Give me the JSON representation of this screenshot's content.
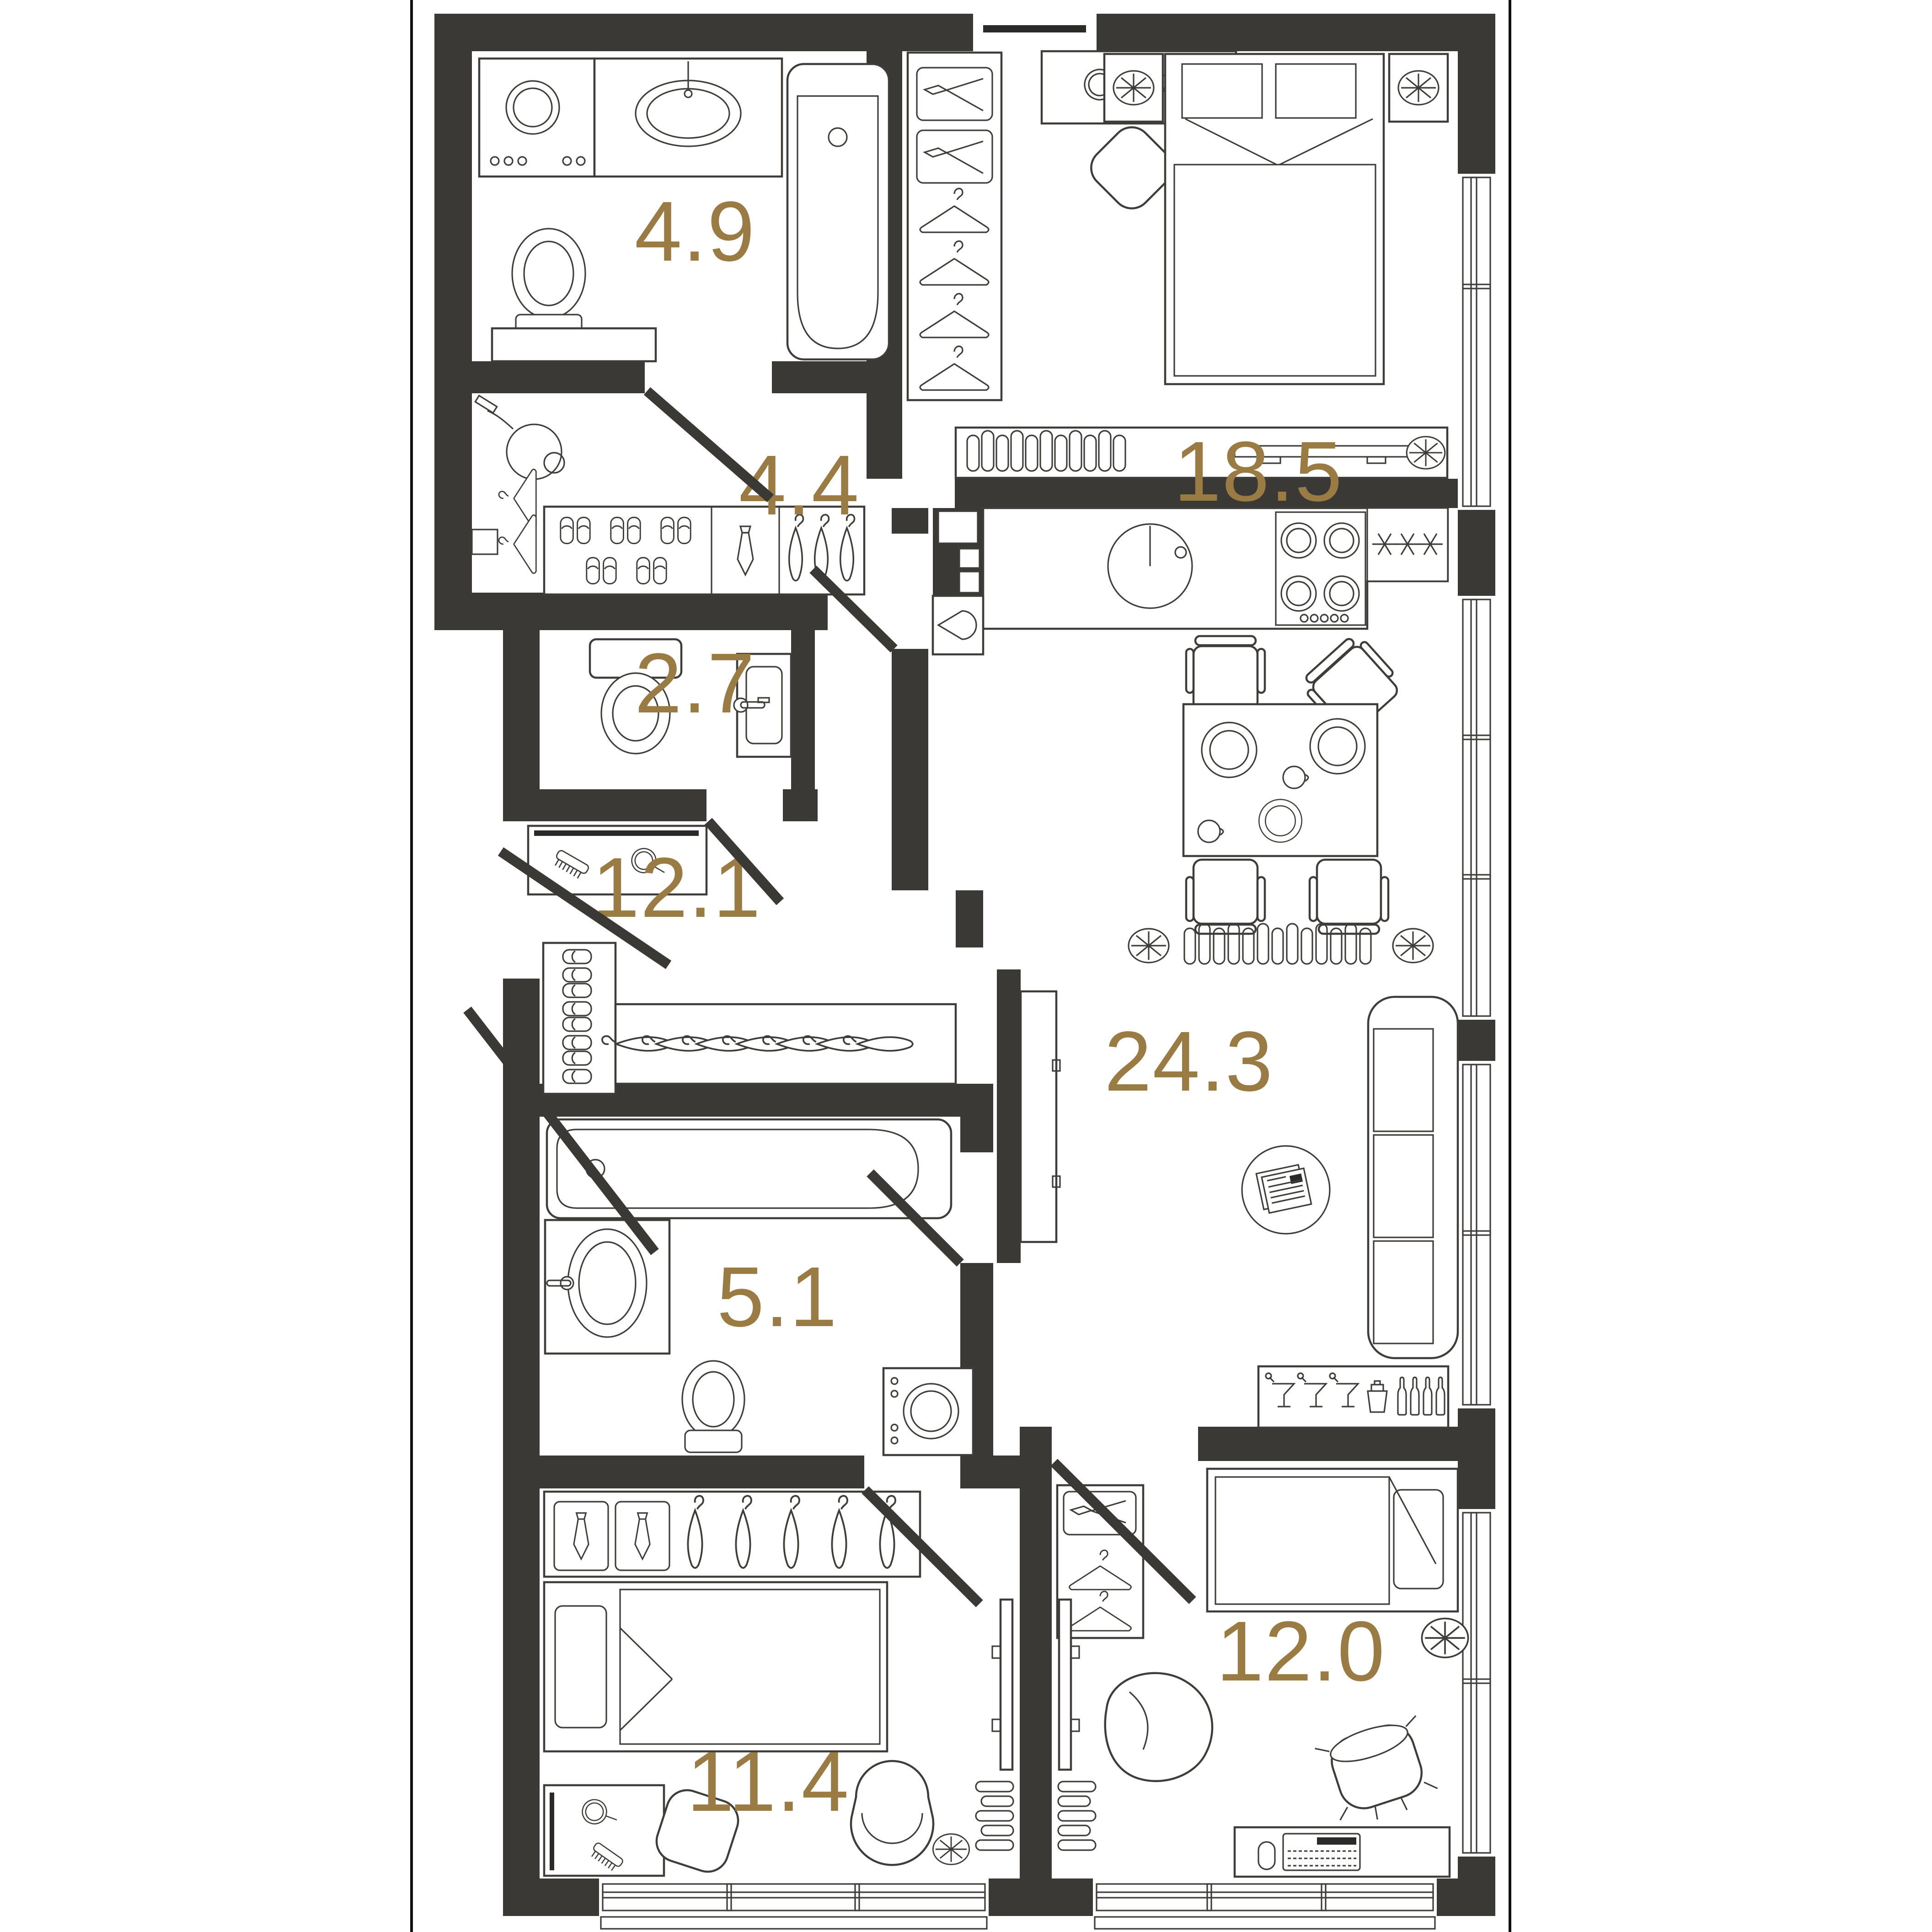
{
  "plan": {
    "type": "apartment-floor-plan",
    "area_unit": "m2",
    "colors": {
      "background": "#ffffff",
      "walls": "#3b3936",
      "furniture_lines": "#3f3d3a",
      "room_labels": "#9a7b44",
      "frame": "#111111"
    },
    "rooms": {
      "bathroom_top": {
        "label": "4.9"
      },
      "hallway": {
        "label": "4.4"
      },
      "bedroom_main": {
        "label": "18.5"
      },
      "wc": {
        "label": "2.7"
      },
      "corridor": {
        "label": "12.1"
      },
      "living_kitchen": {
        "label": "24.3"
      },
      "bathroom_lower": {
        "label": "5.1"
      },
      "bedroom_left": {
        "label": "11.4"
      },
      "bedroom_right": {
        "label": "12.0"
      }
    },
    "furniture_icons": [
      "washing-machine-icon",
      "sink-icon",
      "bathtub-icon",
      "toilet-icon",
      "vacuum-cleaner-icon",
      "hanger-icon",
      "slippers-icon",
      "tie-icon",
      "wardrobe-icon",
      "speaker-box-icon",
      "mirror-icon",
      "comb-icon",
      "double-bed-icon",
      "single-bed-icon",
      "nightstand-lamp-icon",
      "radiator-icon",
      "fan-icon",
      "kitchen-sink-icon",
      "stove-icon",
      "fridge-snowflake-icon",
      "dining-table-icon",
      "chair-icon",
      "plate-icon",
      "cup-icon",
      "tv-icon",
      "sofa-icon",
      "newspaper-table-icon",
      "bar-glasses-icon",
      "bottle-icon",
      "shaker-icon",
      "water-drop-icon",
      "bean-bag-icon",
      "stool-icon",
      "desk-keyboard-icon",
      "mouse-icon",
      "door-swing-icon",
      "window-icon"
    ]
  }
}
